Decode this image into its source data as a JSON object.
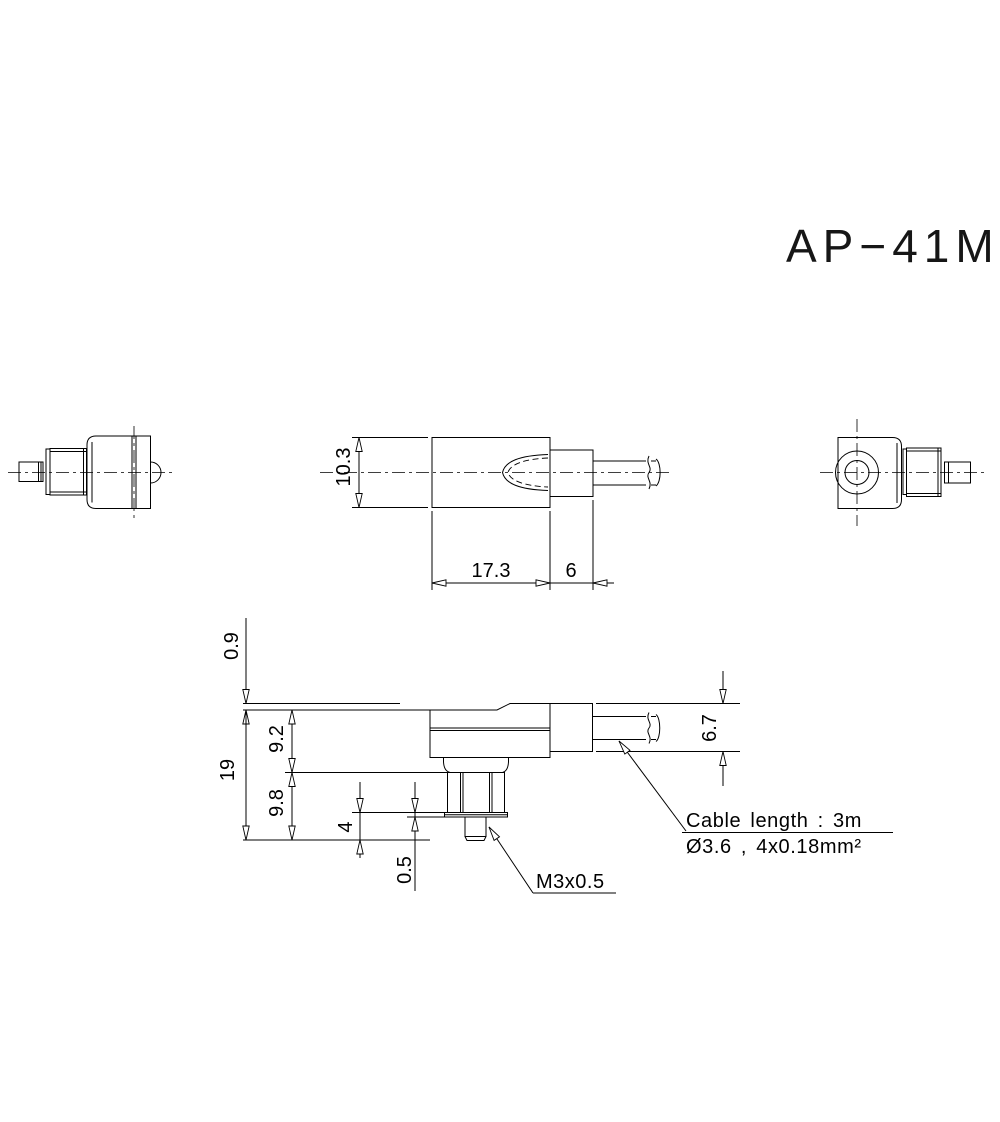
{
  "title": "AP−41M",
  "dimensions": {
    "body_diameter": "10.3",
    "body_length": "17.3",
    "relief_length": "6",
    "flange_offset": "0.9",
    "overall_height": "19",
    "upper_height": "9.2",
    "lower_height": "9.8",
    "stud_length": "4",
    "washer_thickness": "0.5",
    "relief_height": "6.7"
  },
  "labels": {
    "thread": "M3x0.5",
    "cable_note_1": "Cable length : 3m",
    "cable_note_2": "Ø3.6 , 4x0.18mm²"
  }
}
